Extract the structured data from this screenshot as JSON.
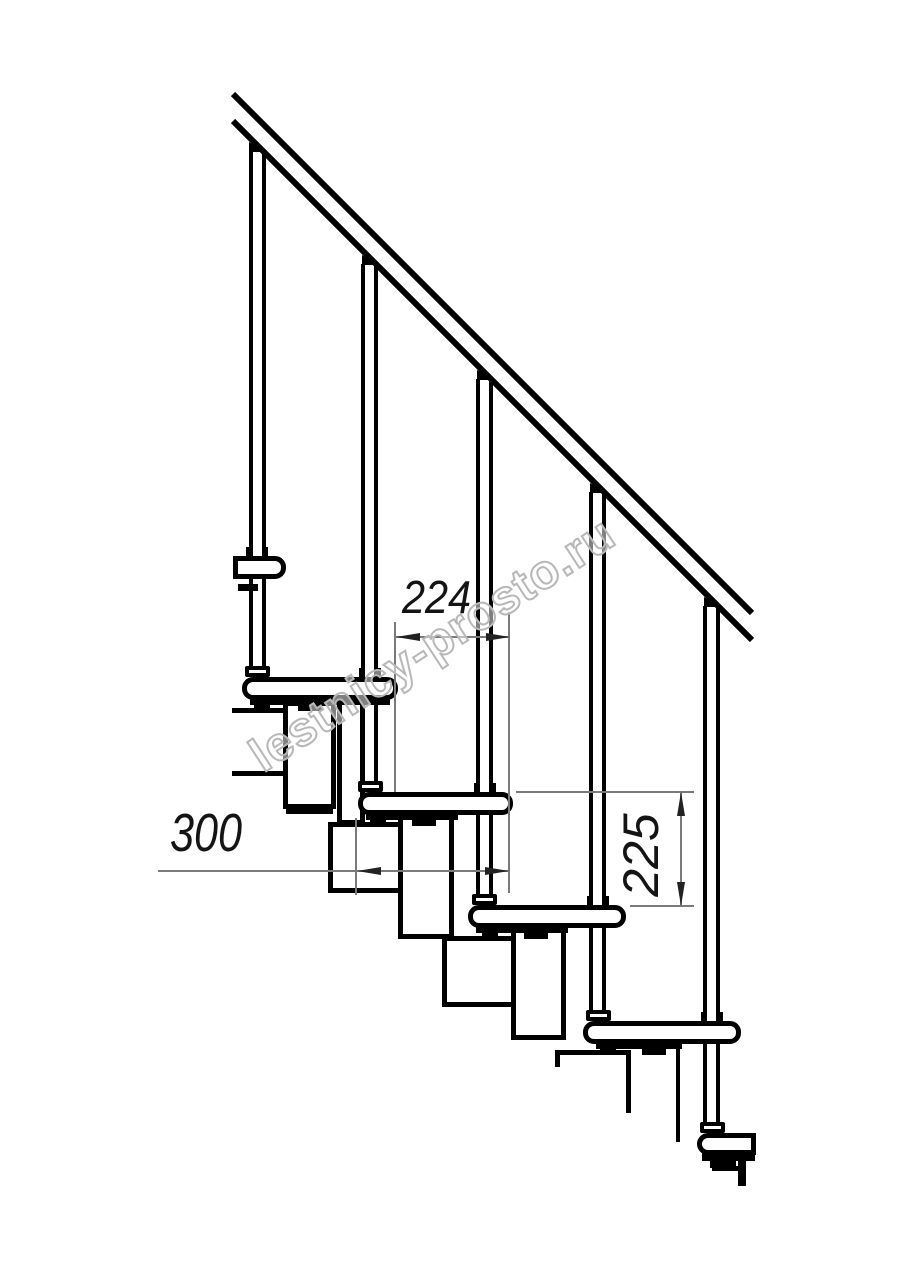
{
  "drawing": {
    "subject": "Modular staircase side elevation drawing",
    "background_color": "#ffffff",
    "line_color": "#000000",
    "dimension_line_color": "#7a7a7a",
    "dimension_text_color": "#141414",
    "watermark": {
      "text": "lestnicy-prosto.ru",
      "color": "#b8b8b8"
    },
    "dimensions": {
      "run": {
        "label": "224",
        "orientation": "horizontal"
      },
      "depth": {
        "label": "300",
        "orientation": "horizontal"
      },
      "rise": {
        "label": "225",
        "orientation": "vertical"
      }
    }
  }
}
